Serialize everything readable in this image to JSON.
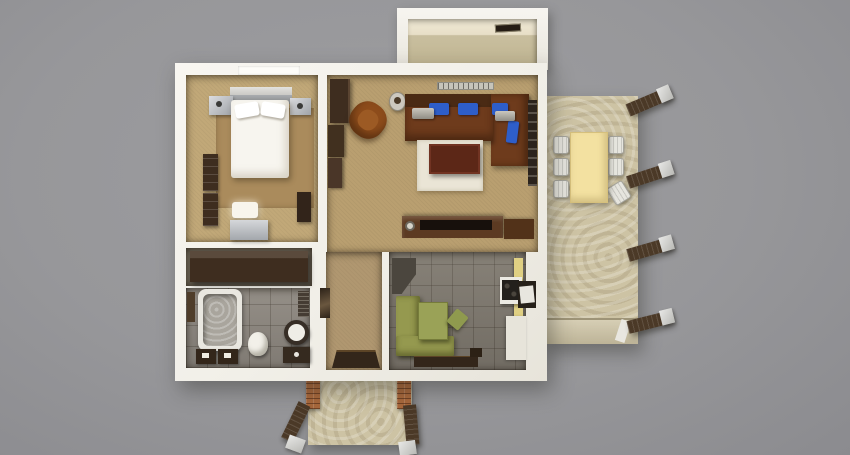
{
  "scene": {
    "title": "Top-down 3D render of a one-bedroom apartment floor plan",
    "view": "top-down",
    "rooms": [
      {
        "id": "bedroom",
        "label": "Bedroom"
      },
      {
        "id": "living-room",
        "label": "Living room"
      },
      {
        "id": "bathroom",
        "label": "Bathroom"
      },
      {
        "id": "kitchen",
        "label": "Kitchen"
      },
      {
        "id": "entry-hall",
        "label": "Entry hall"
      },
      {
        "id": "closet",
        "label": "Closet nook"
      },
      {
        "id": "balcony",
        "label": "Balcony"
      },
      {
        "id": "terrace",
        "label": "Terrace"
      },
      {
        "id": "porch",
        "label": "Entry porch"
      }
    ],
    "furniture": {
      "bedroom": [
        "double-bed",
        "pillows",
        "headboard",
        "nightstand-left",
        "nightstand-right",
        "area-rug",
        "wall-shelves",
        "dresser",
        "table-lamp",
        "stool"
      ],
      "living_room": [
        "corner-sofa",
        "blue-cushions",
        "silver-armrest-cushions",
        "armchair",
        "side-table",
        "coffee-table",
        "white-rug",
        "tv-lowboard",
        "tv",
        "wall-cabinets",
        "radiator",
        "terrace-door"
      ],
      "bathroom": [
        "bathtub",
        "toilet",
        "washbasin",
        "vanity",
        "bath-mats",
        "wall-shelf",
        "radiator"
      ],
      "kitchen": [
        "green-corner-bench",
        "green-table",
        "chair",
        "stove",
        "serving-hatch",
        "wall-cabinets",
        "counter",
        "doormats"
      ],
      "entry_hall": [
        "doormat",
        "wall-mirror"
      ],
      "closet": [
        "wardrobe"
      ],
      "balcony": [
        "air-vent"
      ],
      "terrace": [
        "dining-table",
        "six-chairs",
        "four-pergola-beams"
      ],
      "porch": [
        "brick-pillars",
        "two-canopy-beams"
      ]
    },
    "chair_count_terrace": 6,
    "pergola_beam_count": 4
  },
  "palette": {
    "bg": "#97979a",
    "bg_light": "#9d9da0",
    "bg_dark": "#8b8b8f",
    "wall": "#f1efe8",
    "floor_tan": "#c1a878",
    "floor_tan_dark": "#b99f70",
    "rug_tan": "#aa8b5c",
    "hall_tan": "#b09770",
    "floor_tile": "#8e8880",
    "floor_tile_dark": "#7f796f",
    "floor_stone": "#cdc3a4",
    "wood_dark": "#3e2d1f",
    "wood_mid": "#5c3a22",
    "sofa_brown": "#6e3b1c",
    "sofa_back": "#4a2a14",
    "cushion_blue": "#2e5ec9",
    "armchair_brown": "#8d4c1b",
    "coffee_table": "#5c2717",
    "bench_green": "#95994f",
    "table_green": "#9aa257",
    "dining_yellow": "#f3e1a1",
    "chair_white": "#e6e5de",
    "cabinet_yellow": "#e0d083",
    "white_furn": "#f7f5ef",
    "tub_inner": "#a9a59d",
    "beam_wood": "#4b3927",
    "beam_cap": "#d7d6d2",
    "brick": "#a8683c",
    "mat_dark": "#33261a"
  }
}
